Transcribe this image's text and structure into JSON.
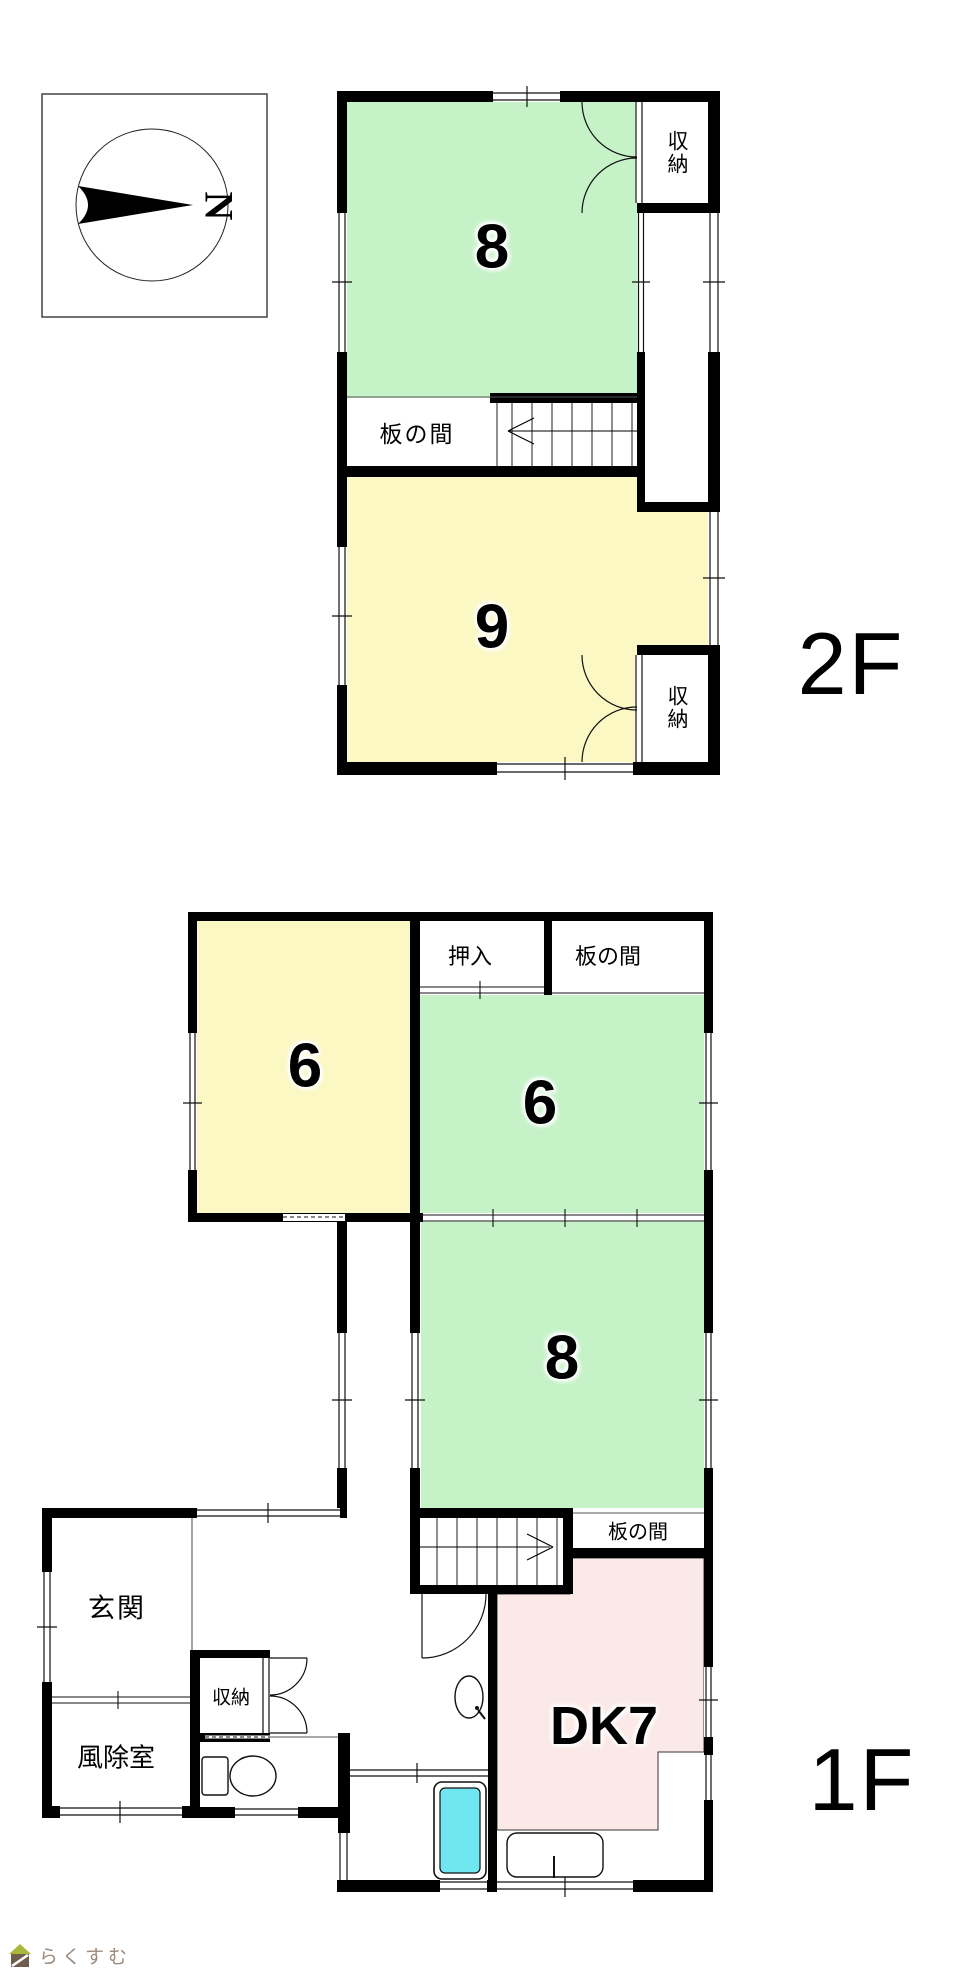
{
  "colors": {
    "wall": "#000000",
    "tatami_green": "#c6f2c8",
    "tatami_yellow": "#fbf8c3",
    "dk_pink": "#fbe9e7",
    "bathtub_cyan": "#70e7f0",
    "logo_text": "#9c8d7e",
    "logo_roof": "#a8b83a",
    "logo_body": "#6f5e4d"
  },
  "compass": {
    "north_label": "N"
  },
  "floor_2f": {
    "floor_label": "2F",
    "rooms": {
      "room_8": {
        "label": "8"
      },
      "room_9": {
        "label": "9"
      },
      "storage_top": {
        "label": "収納"
      },
      "storage_bottom": {
        "label": "収納"
      },
      "itanoma": {
        "label": "板の間"
      }
    }
  },
  "floor_1f": {
    "floor_label": "1F",
    "rooms": {
      "room_6_west": {
        "label": "6"
      },
      "room_6_east": {
        "label": "6"
      },
      "room_8": {
        "label": "8"
      },
      "dk": {
        "label": "DK7"
      },
      "oshiire": {
        "label": "押入"
      },
      "itanoma_north": {
        "label": "板の間"
      },
      "itanoma_center": {
        "label": "板の間"
      },
      "genkan": {
        "label": "玄関"
      },
      "windbreak_room": {
        "label": "風除室"
      },
      "storage": {
        "label": "収納"
      }
    }
  },
  "footer": {
    "brand": "らくすむ"
  }
}
